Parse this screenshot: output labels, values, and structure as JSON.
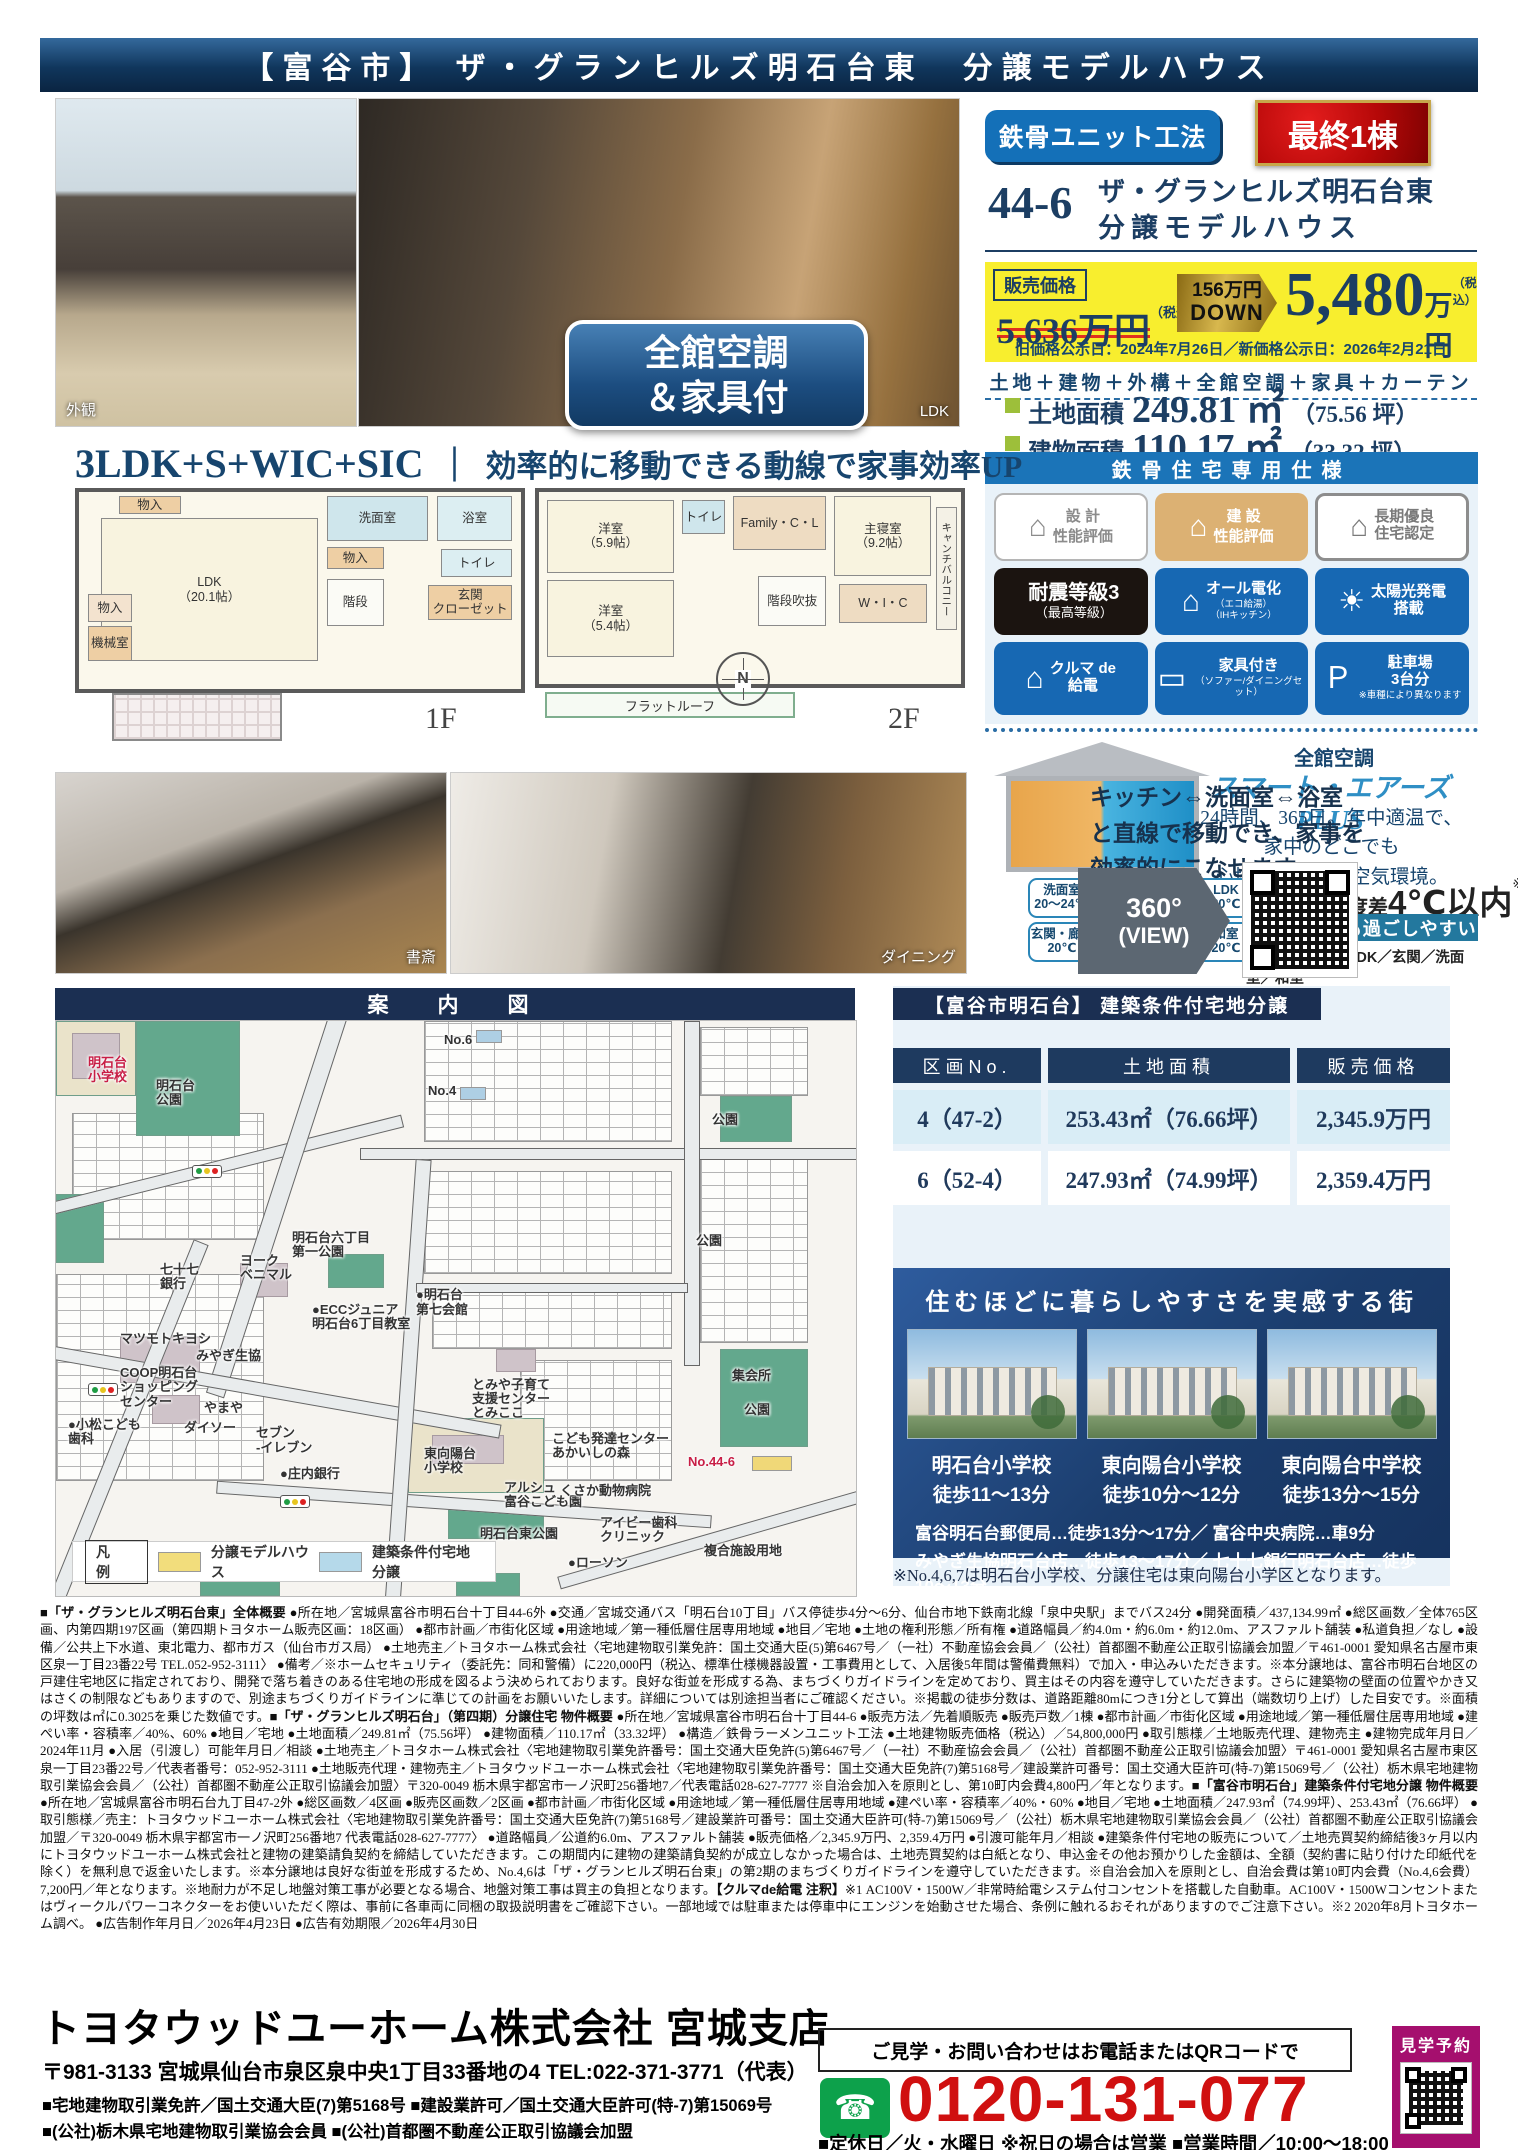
{
  "header": {
    "title": "【富谷市】 ザ・グランヒルズ明石台東　分譲モデルハウス"
  },
  "photos": {
    "exterior_label": "外観",
    "ldk_label": "LDK",
    "badge_line1": "全館空調",
    "badge_line2": "＆家具付",
    "study_label": "書斎",
    "dining_label": "ダイニング"
  },
  "offer": {
    "method_badge": "鉄骨ユニット工法",
    "last_badge": "最終1棟",
    "lot_no": "44-6",
    "name_line1": "ザ・グランヒルズ明石台東",
    "name_line2": "分譲モデルハウス",
    "price_label": "販売価格",
    "old_price": "5,636万円",
    "tax_note": "（税込）",
    "down_amount": "156万円",
    "down_word": "DOWN",
    "new_price_value": "5,480",
    "new_price_unit": "万円",
    "date_note": "旧価格公示日：2024年7月26日／新価格公示日：2026年2月21日",
    "includes": "土地＋建物＋外構＋全館空調＋家具＋カーテン",
    "areas": [
      {
        "label": "土地面積",
        "value": "249.81 ㎡",
        "tsubo": "（75.56 坪）"
      },
      {
        "label": "建物面積",
        "value": "110.17 ㎡",
        "tsubo": "（33.32 坪）"
      }
    ]
  },
  "spec": {
    "title": "鉄骨住宅専用仕様",
    "badges": [
      {
        "c": "b-grayline",
        "icon": "⌂",
        "title": "設 計",
        "sub": "性能評価"
      },
      {
        "c": "b-gold",
        "icon": "⌂",
        "title": "建 設",
        "sub": "性能評価"
      },
      {
        "c": "b-outline",
        "icon": "⌂",
        "title": "長期優良\n住宅認定"
      },
      {
        "c": "b-black",
        "title": "耐震等級3",
        "sub": "（最高等級）"
      },
      {
        "c": "b-blue",
        "icon": "⌂",
        "title": "オール電化",
        "sub": "（エコ給湯）\n（IHキッチン）"
      },
      {
        "c": "b-blue",
        "icon": "☀",
        "title": "太陽光発電\n搭載"
      },
      {
        "c": "b-blue",
        "icon": "⌂",
        "title": "クルマ de\n給電"
      },
      {
        "c": "b-blue",
        "icon": "▭",
        "title": "家具付き",
        "sub": "（ソファー/ダイニングセット）"
      },
      {
        "c": "b-blue",
        "icon": "Ｐ",
        "title": "駐車場\n3台分",
        "sub": "※車種により異なります"
      }
    ]
  },
  "aircon": {
    "title": "全館空調",
    "brand": "スマート・エアーズ PLUS",
    "desc": "24時間、365日。年中適温で、\n家中のどこでも\n心地良い清潔な空気環境。",
    "callouts": [
      {
        "label": "洗面室",
        "temp": "20〜24℃"
      },
      {
        "label": "玄関・廊下",
        "temp": "20℃"
      },
      {
        "label": "LDK",
        "temp": "20℃"
      },
      {
        "label": "和室",
        "temp": "20℃"
      }
    ],
    "diff_pre": "部屋間の温度差",
    "diff_big": "4℃以内",
    "diff_note": "※",
    "comfort": "家中どこでも過ごしやすい",
    "outlets": "【空調吹出口】LDK／玄関／洗面室／和室"
  },
  "plan": {
    "heading_left": "3LDK+S+WIC+SIC",
    "heading_div": "｜",
    "heading_right": "効率的に移動できる動線で家事効率UP",
    "floor1_label": "1F",
    "floor2_label": "2F",
    "compass_n": "N",
    "flow_text": "キッチン⇔洗面室⇔浴室\nと直線で移動でき、家事を\n効率的にこなせます。",
    "view360_line1": "360°",
    "view360_line2": "(VIEW)",
    "rooms1": [
      {
        "t": "物入",
        "x": 9,
        "y": 2,
        "w": 14,
        "h": 9,
        "bg": "#eecfa4"
      },
      {
        "t": "LDK\n（20.1帖）",
        "x": 5,
        "y": 13,
        "w": 49,
        "h": 73,
        "bg": "#f8f3df"
      },
      {
        "t": "洗面室",
        "x": 56,
        "y": 2,
        "w": 23,
        "h": 23,
        "bg": "#cfe6ec"
      },
      {
        "t": "浴室",
        "x": 81,
        "y": 2,
        "w": 17,
        "h": 23,
        "bg": "#dceef2"
      },
      {
        "t": "物入",
        "x": 56,
        "y": 28,
        "w": 13,
        "h": 11,
        "bg": "#eecfa4"
      },
      {
        "t": "トイレ",
        "x": 82,
        "y": 29,
        "w": 16,
        "h": 14,
        "bg": "#dceef2"
      },
      {
        "t": "玄関\nクローゼット",
        "x": 79,
        "y": 47,
        "w": 19,
        "h": 18,
        "bg": "#eecfa4"
      },
      {
        "t": "物入",
        "x": 2,
        "y": 52,
        "w": 10,
        "h": 14,
        "bg": "#f3e3cf"
      },
      {
        "t": "機械室",
        "x": 2,
        "y": 68,
        "w": 10,
        "h": 18,
        "bg": "#eecfa4"
      },
      {
        "t": "階段",
        "x": 56,
        "y": 44,
        "w": 13,
        "h": 24,
        "bg": "#fbfbf6"
      }
    ],
    "rooms2": [
      {
        "t": "洋室\n（5.9帖）",
        "x": 2,
        "y": 4,
        "w": 30,
        "h": 38,
        "bg": "#f8f3df"
      },
      {
        "t": "トイレ",
        "x": 34,
        "y": 4,
        "w": 10,
        "h": 18,
        "bg": "#cfe6ec"
      },
      {
        "t": "Family・C・L",
        "x": 46,
        "y": 2,
        "w": 22,
        "h": 28,
        "bg": "#eedcc2"
      },
      {
        "t": "主寝室\n（9.2帖）",
        "x": 70,
        "y": 2,
        "w": 23,
        "h": 42,
        "bg": "#f8f3df"
      },
      {
        "t": "洋室\n（5.4帖）",
        "x": 2,
        "y": 46,
        "w": 30,
        "h": 40,
        "bg": "#f8f3df"
      },
      {
        "t": "階段吹抜",
        "x": 52,
        "y": 44,
        "w": 16,
        "h": 26,
        "bg": "#fbfbf6"
      },
      {
        "t": "W・I・C",
        "x": 71,
        "y": 48,
        "w": 21,
        "h": 20,
        "bg": "#eedcc2"
      },
      {
        "t": "キャンチバルコニー",
        "x": 94,
        "y": 8,
        "w": 5,
        "h": 64,
        "bg": "#f4f1e6",
        "c": "vert"
      }
    ],
    "flatroof_label": "フラットルーフ"
  },
  "map": {
    "title": "案　内　図",
    "shapes": [
      {
        "c": "grid",
        "x": 2,
        "y": 16,
        "w": 24,
        "h": 22
      },
      {
        "c": "grid",
        "x": 0,
        "y": 44,
        "w": 26,
        "h": 36
      },
      {
        "c": "grid",
        "x": 46,
        "y": 0,
        "w": 31,
        "h": 21
      },
      {
        "c": "grid",
        "x": 46,
        "y": 26,
        "w": 31,
        "h": 18
      },
      {
        "c": "grid",
        "x": 47,
        "y": 47,
        "w": 30,
        "h": 10
      },
      {
        "c": "grid",
        "x": 58,
        "y": 59,
        "w": 19,
        "h": 21
      },
      {
        "c": "grid",
        "x": 80.5,
        "y": 1,
        "w": 13.5,
        "h": 12
      },
      {
        "c": "grid",
        "x": 80.5,
        "y": 24,
        "w": 13.5,
        "h": 32
      },
      {
        "c": "park",
        "x": 10,
        "y": 0,
        "w": 13,
        "h": 20,
        "bg": "#63a88d"
      },
      {
        "c": "park",
        "x": 0,
        "y": 0,
        "w": 10,
        "h": 13,
        "bg": "#eae3ca"
      },
      {
        "c": "park",
        "x": 0,
        "y": 30,
        "w": 6,
        "h": 12,
        "bg": "#63a88d"
      },
      {
        "c": "park",
        "x": 34,
        "y": 40.5,
        "w": 7,
        "h": 6,
        "bg": "#63a88d"
      },
      {
        "c": "park",
        "x": 83,
        "y": 13,
        "w": 9,
        "h": 8,
        "bg": "#63a88d"
      },
      {
        "c": "park",
        "x": 83,
        "y": 57,
        "w": 11,
        "h": 17,
        "bg": "#63a88d"
      },
      {
        "c": "park",
        "x": 44,
        "y": 69,
        "w": 17,
        "h": 13,
        "bg": "#eae3ca"
      },
      {
        "c": "park",
        "x": 49,
        "y": 84,
        "w": 12,
        "h": 6,
        "bg": "#63a88d"
      },
      {
        "c": "park",
        "x": 18,
        "y": 94,
        "w": 10,
        "h": 6,
        "bg": "#63a88d"
      },
      {
        "c": "park",
        "x": 50,
        "y": 96,
        "w": 8,
        "h": 4,
        "bg": "#63a88d"
      },
      {
        "c": "bld",
        "x": 8,
        "y": 55,
        "w": 10,
        "h": 8,
        "bg": "#cfc3c9"
      },
      {
        "c": "bld",
        "x": 23,
        "y": 42,
        "w": 6,
        "h": 6,
        "bg": "#cfc3c9"
      },
      {
        "c": "bld",
        "x": 12,
        "y": 65,
        "w": 6,
        "h": 5,
        "bg": "#cfc3c9"
      },
      {
        "c": "bld",
        "x": 47,
        "y": 72,
        "w": 9,
        "h": 5,
        "bg": "#cfc3c9"
      },
      {
        "c": "bld",
        "x": 2,
        "y": 2,
        "w": 6,
        "h": 8,
        "bg": "#cfc3c9"
      },
      {
        "c": "bld",
        "x": 55,
        "y": 57,
        "w": 5,
        "h": 4,
        "bg": "#cfc3c9"
      },
      {
        "c": "road",
        "x": -2,
        "y": 24,
        "w": 46,
        "h": 2.2,
        "r": -14
      },
      {
        "c": "road",
        "x": 38,
        "y": 22,
        "w": 64,
        "h": 2.2
      },
      {
        "c": "road",
        "x": 27,
        "y": -8,
        "w": 2.4,
        "h": 75,
        "r": 18
      },
      {
        "c": "road",
        "x": -4,
        "y": 63,
        "w": 60,
        "h": 2.4,
        "r": 10
      },
      {
        "c": "road",
        "x": 20,
        "y": 83,
        "w": 62,
        "h": 2.2,
        "r": 4
      },
      {
        "c": "road",
        "x": 43,
        "y": 24,
        "w": 2,
        "h": 78,
        "r": 4
      },
      {
        "c": "road",
        "x": 78.5,
        "y": 0,
        "w": 2,
        "h": 60
      },
      {
        "c": "road",
        "x": 45,
        "y": 45.5,
        "w": 34,
        "h": 1.8
      },
      {
        "c": "road",
        "x": 62,
        "y": 88,
        "w": 45,
        "h": 2.2,
        "r": -16
      },
      {
        "c": "road",
        "x": 8,
        "y": 36,
        "w": 2,
        "h": 68,
        "r": 22
      },
      {
        "c": "sw",
        "x": 52.5,
        "y": 1.6,
        "w": 3.2,
        "h": 2.3,
        "bg": "#aecfe4"
      },
      {
        "c": "sw",
        "x": 50.5,
        "y": 11.4,
        "w": 3.2,
        "h": 2.3,
        "bg": "#aecfe4"
      },
      {
        "c": "sw",
        "x": 87,
        "y": 75.6,
        "w": 5,
        "h": 2.6,
        "bg": "#f0d878"
      }
    ],
    "traffic": [
      {
        "x": 17,
        "y": 25
      },
      {
        "x": 4,
        "y": 63
      },
      {
        "x": 28,
        "y": 82.5
      }
    ],
    "labels": [
      {
        "t": "明石台\n小学校",
        "x": 4,
        "y": 6,
        "c": "red"
      },
      {
        "t": "明石台\n公園",
        "x": 12.5,
        "y": 10
      },
      {
        "t": "No.6",
        "x": 48.5,
        "y": 2
      },
      {
        "t": "No.4",
        "x": 46.5,
        "y": 11
      },
      {
        "t": "公園",
        "x": 82,
        "y": 16
      },
      {
        "t": "公園",
        "x": 80,
        "y": 37
      },
      {
        "t": "七十七\n銀行",
        "x": 13,
        "y": 42
      },
      {
        "t": "ヨーク\nベニマル",
        "x": 23,
        "y": 40.5
      },
      {
        "t": "明石台六丁目\n第一公園",
        "x": 29.5,
        "y": 36.5
      },
      {
        "t": "●ECCジュニア\n明石台6丁目教室",
        "x": 32,
        "y": 49
      },
      {
        "t": "●明石台\n第七会館",
        "x": 45,
        "y": 46.5
      },
      {
        "t": "マツモトキヨシ",
        "x": 8,
        "y": 54
      },
      {
        "t": "みやぎ生協",
        "x": 17.5,
        "y": 57
      },
      {
        "t": "COOP明石台\nショッピング\nセンター",
        "x": 8,
        "y": 60
      },
      {
        "t": "やまや",
        "x": 18.5,
        "y": 66
      },
      {
        "t": "●小松こども\n歯科",
        "x": 1.5,
        "y": 69
      },
      {
        "t": "ダイソー",
        "x": 16,
        "y": 69.5
      },
      {
        "t": "セブン\n-イレブン",
        "x": 25,
        "y": 70.5
      },
      {
        "t": "●庄内銀行",
        "x": 28,
        "y": 77.5
      },
      {
        "t": "東向陽台\n小学校",
        "x": 46,
        "y": 74
      },
      {
        "t": "とみや子育て\n支援センター\nとみここ",
        "x": 52,
        "y": 62
      },
      {
        "t": "こども発達センター\nあかいしの森",
        "x": 62,
        "y": 71.5
      },
      {
        "t": "アルシュ\n富谷こども園",
        "x": 56,
        "y": 80
      },
      {
        "t": "明石台東公園",
        "x": 53,
        "y": 88
      },
      {
        "t": "くさか動物病院",
        "x": 63,
        "y": 80.5
      },
      {
        "t": "アイビー歯科\nクリニック",
        "x": 68,
        "y": 86
      },
      {
        "t": "●ローソン",
        "x": 64,
        "y": 93
      },
      {
        "t": "集会所",
        "x": 84.5,
        "y": 60.5
      },
      {
        "t": "公園",
        "x": 86,
        "y": 66.5
      },
      {
        "t": "No.44-6",
        "x": 79,
        "y": 75.5,
        "c": "red"
      },
      {
        "t": "複合施設用地",
        "x": 81,
        "y": 91
      }
    ],
    "legend": {
      "title": "凡 例",
      "items": [
        {
          "label": "分譲モデルハウス",
          "color": "#f2dd7c"
        },
        {
          "label": "建築条件付宅地分譲",
          "color": "#b5d9ea"
        }
      ]
    },
    "labels_red_color": "#c81e46",
    "labels_blue_color": "#1f5fa8"
  },
  "lots": {
    "title": "【富谷市明石台】 建築条件付宅地分譲",
    "columns": [
      "区画No.",
      "土地面積",
      "販売価格"
    ],
    "rows": [
      [
        "4（47-2）",
        "253.43㎡（76.66坪）",
        "2,345.9万円"
      ],
      [
        "6（52-4）",
        "247.93㎡（74.99坪）",
        "2,359.4万円"
      ]
    ]
  },
  "town": {
    "title": "住むほどに暮らしやすさを実感する街",
    "schools": [
      {
        "name": "明石台小学校",
        "walk": "徒歩11〜13分"
      },
      {
        "name": "東向陽台小学校",
        "walk": "徒歩10分〜12分"
      },
      {
        "name": "東向陽台中学校",
        "walk": "徒歩13分〜15分"
      }
    ],
    "facilities1": "富谷明石台郵便局…徒歩13分〜17分／ 富谷中央病院…車9分",
    "facilities2": "みやぎ生協明石台店…徒歩13〜17分／ 七十七銀行明石台店…徒歩10〜13分",
    "note": "※No.4,6,7は明石台小学校、分譲住宅は東向陽台小学区となります。"
  },
  "fineprint": {
    "segments": [
      {
        "c": "b",
        "t": "■「ザ・グランヒルズ明石台東」全体概要 "
      },
      {
        "t": "●所在地／宮城県富谷市明石台十丁目44-6外 ●交通／宮城交通バス「明石台10丁目」バス停徒歩4分〜6分、仙台市地下鉄南北線「泉中央駅」までバス24分 ●開発面積／437,134.99㎡ ●総区画数／全体765区画、内第四期197区画（第四期トヨタホーム販売区画：18区画） ●都市計画／市街化区域 ●用途地域／第一種低層住居専用地域 ●地目／宅地 ●土地の権利形態／所有権 ●道路幅員／約4.0m・約6.0m・約12.0m、アスファルト舗装 ●私道負担／なし ●設備／公共上下水道、東北電力、都市ガス（仙台市ガス局） ●土地売主／トヨタホーム株式会社〈宅地建物取引業免許：国土交通大臣(5)第6467号／（一社）不動産協会会員／（公社）首都圏不動産公正取引協議会加盟／〒461-0001 愛知県名古屋市東区泉一丁目23番22号 TEL.052-952-3111〉 ●備考／※ホームセキュリティ（委託先：同和警備）に220,000円（税込、標準仕様機器設置・工事費用として、入居後5年間は警備費無料）で加入・申込みいただきます。※本分譲地は、富谷市明石台地区の戸建住宅地区に指定されており、開発で落ち着きのある住宅地の形成を図るよう決められております。良好な街並を形成する為、まちづくりガイドラインを定めており、買主はその内容を遵守していただきます。さらに建築物の壁面の位置やかき又はさくの制限などもありますので、別途まちづくりガイドラインに準じての計画をお願いいたします。詳細については別途担当者にご確認ください。※掲載の徒歩分数は、道路距離80mにつき1分として算出（端数切り上げ）した目安です。※面積の坪数は㎡に0.3025を乗じた数値です。"
      },
      {
        "c": "b",
        "t": "■「ザ・グランヒルズ明石台」（第四期）分譲住宅 物件概要 "
      },
      {
        "t": "●所在地／宮城県富谷市明石台十丁目44-6 ●販売方法／先着順販売 ●販売戸数／1棟 ●都市計画／市街化区域 ●用途地域／第一種低層住居専用地域 ●建ぺい率・容積率／40%、60% ●地目／宅地 ●土地面積／249.81㎡（75.56坪） ●建物面積／110.17㎡（33.32坪） ●構造／鉄骨ラーメンユニット工法 ●土地建物販売価格（税込）／54,800,000円 ●取引態様／土地販売代理、建物売主 ●建物完成年月日／2024年11月 ●入居（引渡し）可能年月日／相談 ●土地売主／トヨタホーム株式会社〈宅地建物取引業免許番号：国土交通大臣免許(5)第6467号／（一社）不動産協会会員／（公社）首都圏不動産公正取引協議会加盟〉〒461-0001 愛知県名古屋市東区泉一丁目23番22号／代表者番号：052-952-3111 ●土地販売代理・建物売主／トヨタウッドユーホーム株式会社〈宅地建物取引業免許番号：国土交通大臣免許(7)第5168号／建設業許可番号：国土交通大臣許可(特-7)第15069号／（公社）栃木県宅地建物取引業協会会員／（公社）首都圏不動産公正取引協議会加盟〉〒320-0049 栃木県宇都宮市一ノ沢町256番地7／代表電話028-627-7777 ※自治会加入を原則とし、第10町内会費4,800円／年となります。"
      },
      {
        "c": "b",
        "t": "■「富谷市明石台」建築条件付宅地分譲 物件概要 "
      },
      {
        "t": "●所在地／宮城県富谷市明石台九丁目47-2外 ●総区画数／4区画 ●販売区画数／2区画 ●都市計画／市街化区域 ●用途地域／第一種低層住居専用地域 ●建ぺい率・容積率／40%・60% ●地目／宅地 ●土地面積／247.93㎡（74.99坪）、253.43㎡（76.66坪） ●取引態様／売主：トヨタウッドユーホーム株式会社〈宅地建物取引業免許番号：国土交通大臣免許(7)第5168号／建設業許可番号：国土交通大臣許可(特-7)第15069号／（公社）栃木県宅地建物取引業協会会員／（公社）首都圏不動産公正取引協議会加盟／〒320-0049 栃木県宇都宮市一ノ沢町256番地7 代表電話028-627-7777〉 ●道路幅員／公道約6.0m、アスファルト舗装 ●販売価格／2,345.9万円、2,359.4万円 ●引渡可能年月／相談 ●建築条件付宅地の販売について／土地売買契約締結後3ヶ月以内にトヨタウッドユーホーム株式会社と建物の建築請負契約を締結していただきます。この期間内に建物の建築請負契約が成立しなかった場合は、土地売買契約は白紙となり、申込金その他お預かりした金額は、全額（契約書に貼り付けた印紙代を除く）を無利息で返金いたします。※本分譲地は良好な街並を形成するため、No.4,6は「ザ・グランヒルズ明石台東」の第2期のまちづくりガイドラインを遵守していただきます。※自治会加入を原則とし、自治会費は第10町内会費（No.4,6会費）7,200円／年となります。※地耐力が不足し地盤対策工事が必要となる場合、地盤対策工事は買主の負担となります。"
      },
      {
        "c": "b",
        "t": "【クルマde給電 注釈】"
      },
      {
        "t": "※1 AC100V・1500W／非常時給電システム付コンセントを搭載した自動車。AC100V・1500Wコンセントまたはヴィークルパワーコネクターをお使いいただく際は、事前に各車両に同梱の取扱説明書をご確認下さい。一部地域では駐車または停車中にエンジンを始動させた場合、条例に触れるおそれがありますのでご注意下さい。※2 2020年8月トヨタホーム調べ。 ●広告制作年月日／2026年4月23日 ●広告有効期限／2026年4月30日"
      }
    ]
  },
  "footer": {
    "company": "トヨタウッドユーホーム株式会社 宮城支店",
    "address": "〒981-3133 宮城県仙台市泉区泉中央1丁目33番地の4  TEL:022-371-3771（代表）",
    "license1": "■宅地建物取引業免許／国土交通大臣(7)第5168号  ■建設業許可／国土交通大臣許可(特-7)第15069号",
    "license2": "■(公社)栃木県宅地建物取引業協会会員  ■(公社)首都圏不動産公正取引協議会加盟",
    "contact_note": "ご見学・お問い合わせはお電話またはQRコードで",
    "freedial_icon": "☎",
    "phone": "0120-131-077",
    "hours": "■定休日／火・水曜日 ※祝日の場合は営業 ■営業時間／10:00〜18:00",
    "reserve_label": "見学予約"
  }
}
